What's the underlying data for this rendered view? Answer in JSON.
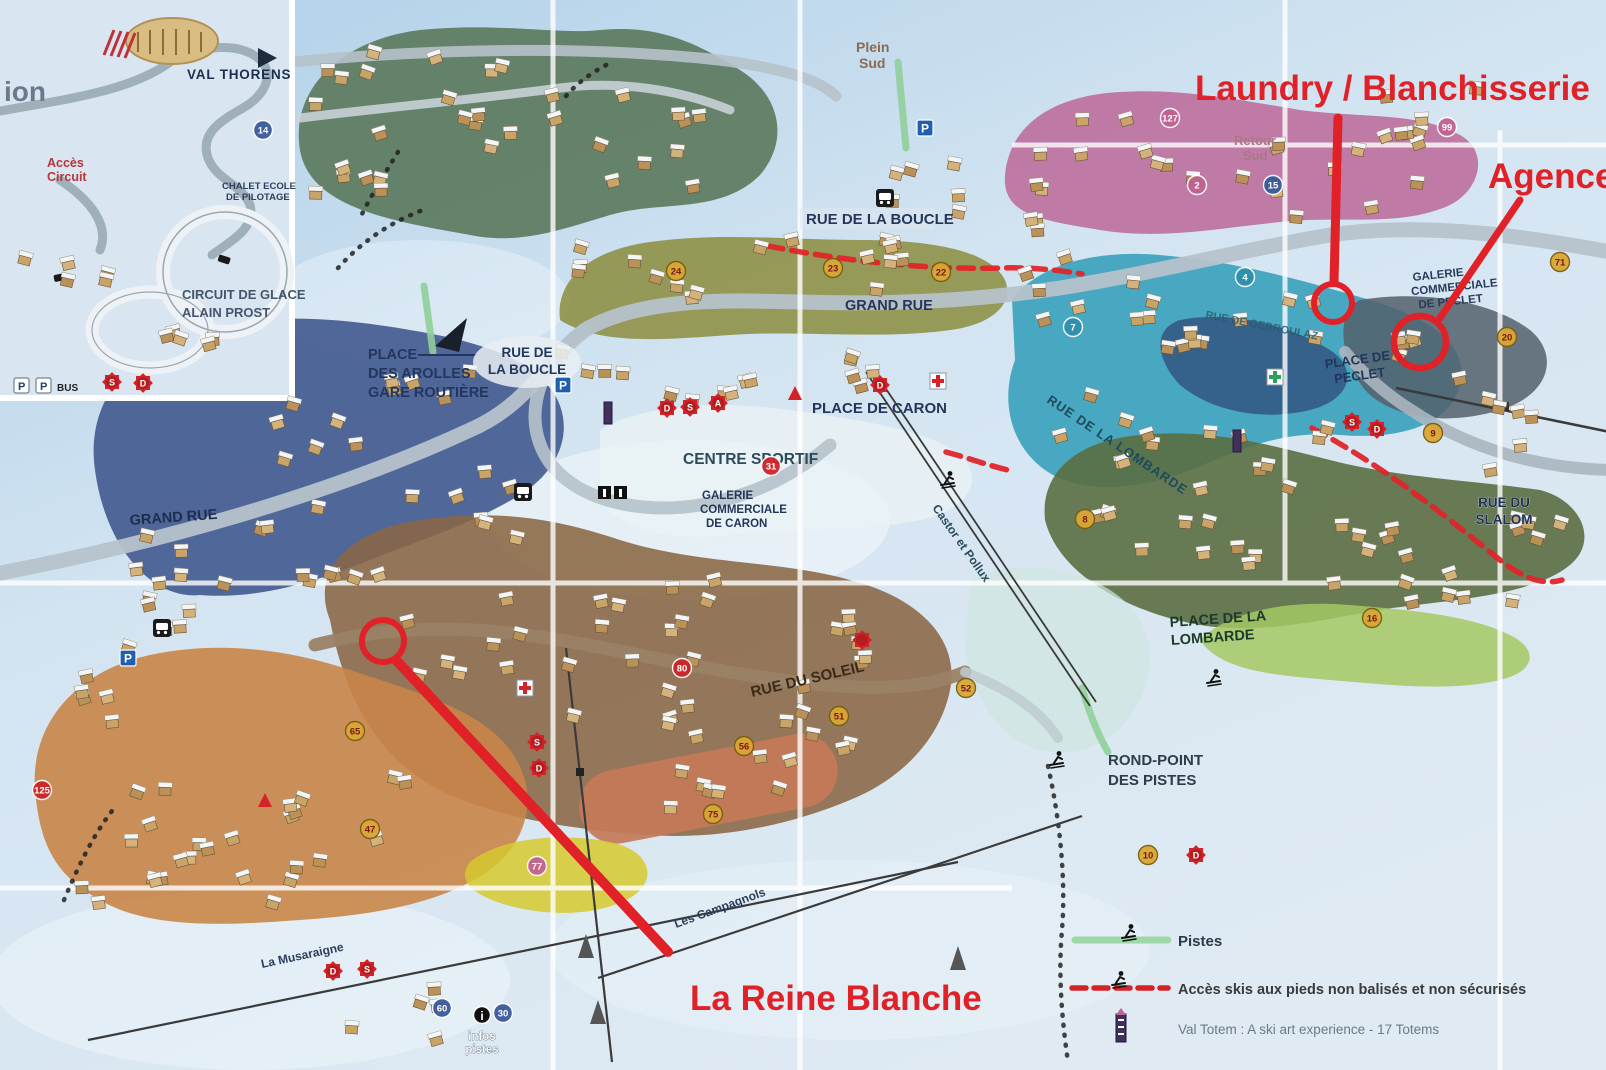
{
  "annotations": {
    "laundry_label": "Laundry / Blanchisserie",
    "agence_label": "Agence",
    "reine_blanche_label": "La Reine Blanche"
  },
  "inset": {
    "resort_name": "VAL THORENS",
    "partial_text": "ion",
    "acces_l1": "Accès",
    "acces_l2": "Circuit",
    "circuit_l1": "CIRCUIT DE GLACE",
    "circuit_l2": "ALAIN PROST",
    "chalet_l1": "CHALET ECOLE",
    "chalet_l2": "DE PILOTAGE"
  },
  "icons": {
    "parking_label": "P",
    "bus_label": "BUS",
    "info_label": "i"
  },
  "streets": {
    "rue_de_la_boucle_top": "RUE DE LA BOUCLE",
    "grand_rue_center": "GRAND RUE",
    "grand_rue_left": "GRAND RUE",
    "place_arolles_l1": "PLACE",
    "place_arolles_l2": "DES AROLLES",
    "place_arolles_l3": "GARE ROUTIÈRE",
    "rue_boucle_sign_l1": "RUE DE",
    "rue_boucle_sign_l2": "LA BOUCLE",
    "place_de_caron": "PLACE DE CARON",
    "centre_sportif": "CENTRE SPORTIF",
    "galerie_caron_l1": "GALERIE",
    "galerie_caron_l2": "COMMERCIALE",
    "galerie_caron_l3": "DE CARON",
    "rue_du_soleil": "RUE DU SOLEIL",
    "place_lombarde_l1": "PLACE DE LA",
    "place_lombarde_l2": "LOMBARDE",
    "rue_lombarde": "RUE DE LA LOMBARDE",
    "place_peclet_l1": "PLACE DE",
    "place_peclet_l2": "PECLET",
    "galerie_peclet_l1": "GALERIE",
    "galerie_peclet_l2": "COMMERCIALE",
    "galerie_peclet_l3": "DE PECLET",
    "rue_gebroulaz": "RUE DE GEBROULAZ",
    "rue_slalom_l1": "RUE DU",
    "rue_slalom_l2": "SLALOM",
    "rond_point_l1": "ROND-POINT",
    "rond_point_l2": "DES PISTES",
    "infos_l1": "infos",
    "infos_l2": "pistes"
  },
  "lifts": {
    "plein_sud_l1": "Plein",
    "plein_sud_l2": "Sud",
    "retour_sud_l1": "Retour",
    "retour_sud_l2": "Sud",
    "castor": "Castor et Pollux",
    "musaraigne": "La Musaraigne",
    "campagnols": "Les Campagnols"
  },
  "legend": {
    "pistes": "Pistes",
    "acces": "Accès skis aux pieds non balisés et non sécurisés",
    "totem": "Val Totem : A ski art experience - 17 Totems"
  },
  "badges": [
    {
      "n": "23",
      "x": 833,
      "y": 268,
      "t": "gold"
    },
    {
      "n": "22",
      "x": 941,
      "y": 272,
      "t": "gold"
    },
    {
      "n": "24",
      "x": 676,
      "y": 271,
      "t": "gold"
    },
    {
      "n": "31",
      "x": 771,
      "y": 466,
      "t": "red"
    },
    {
      "n": "75",
      "x": 713,
      "y": 814,
      "t": "gold"
    },
    {
      "n": "16",
      "x": 1372,
      "y": 618,
      "t": "gold"
    },
    {
      "n": "71",
      "x": 1560,
      "y": 262,
      "t": "gold"
    },
    {
      "n": "99",
      "x": 1447,
      "y": 127,
      "t": "pink"
    },
    {
      "n": "80",
      "x": 682,
      "y": 668,
      "t": "red"
    },
    {
      "n": "9",
      "x": 1433,
      "y": 433,
      "t": "gold"
    },
    {
      "n": "20",
      "x": 1507,
      "y": 337,
      "t": "gold"
    },
    {
      "n": "2",
      "x": 1197,
      "y": 185,
      "t": "pink"
    },
    {
      "n": "4",
      "x": 1245,
      "y": 277,
      "t": "teal"
    },
    {
      "n": "7",
      "x": 1073,
      "y": 327,
      "t": "teal"
    },
    {
      "n": "8",
      "x": 1085,
      "y": 519,
      "t": "gold"
    },
    {
      "n": "77",
      "x": 537,
      "y": 866,
      "t": "pink"
    },
    {
      "n": "65",
      "x": 355,
      "y": 731,
      "t": "gold"
    },
    {
      "n": "47",
      "x": 370,
      "y": 829,
      "t": "gold"
    },
    {
      "n": "56",
      "x": 744,
      "y": 746,
      "t": "gold"
    },
    {
      "n": "51",
      "x": 839,
      "y": 716,
      "t": "gold"
    },
    {
      "n": "52",
      "x": 966,
      "y": 688,
      "t": "gold"
    },
    {
      "n": "127",
      "x": 1170,
      "y": 118,
      "t": "pink"
    },
    {
      "n": "15",
      "x": 1273,
      "y": 185,
      "t": "blue"
    },
    {
      "n": "14",
      "x": 263,
      "y": 130,
      "t": "blue"
    },
    {
      "n": "10",
      "x": 1148,
      "y": 855,
      "t": "gold"
    },
    {
      "n": "60",
      "x": 442,
      "y": 1008,
      "t": "blue"
    },
    {
      "n": "30",
      "x": 503,
      "y": 1013,
      "t": "blue"
    },
    {
      "n": "125",
      "x": 42,
      "y": 790,
      "t": "red"
    }
  ],
  "markers": [
    {
      "letter": "S",
      "x": 112,
      "y": 382
    },
    {
      "letter": "D",
      "x": 143,
      "y": 383
    },
    {
      "letter": "D",
      "x": 667,
      "y": 408
    },
    {
      "letter": "S",
      "x": 690,
      "y": 407
    },
    {
      "letter": "A",
      "x": 718,
      "y": 403
    },
    {
      "letter": "D",
      "x": 880,
      "y": 385
    },
    {
      "letter": "S",
      "x": 537,
      "y": 742
    },
    {
      "letter": "D",
      "x": 539,
      "y": 768
    },
    {
      "letter": "S",
      "x": 1352,
      "y": 422
    },
    {
      "letter": "D",
      "x": 1377,
      "y": 429
    },
    {
      "letter": "D",
      "x": 333,
      "y": 971
    },
    {
      "letter": "S",
      "x": 367,
      "y": 969
    },
    {
      "letter": "D",
      "x": 1196,
      "y": 855
    },
    {
      "letter": "",
      "x": 862,
      "y": 640
    }
  ]
}
